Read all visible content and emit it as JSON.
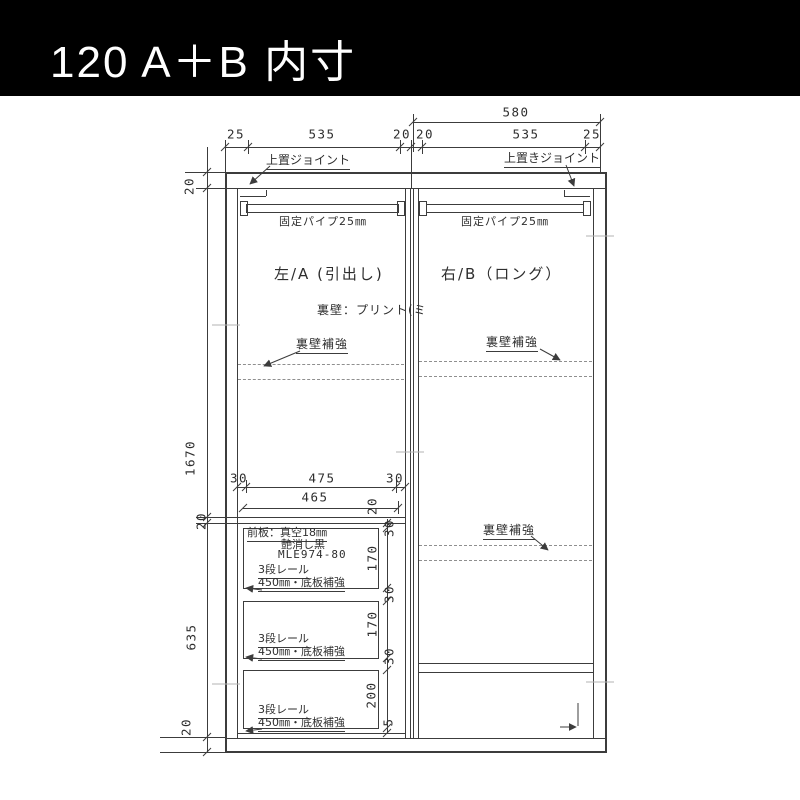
{
  "header": {
    "title": "120  A＋B  内寸"
  },
  "dimensions": {
    "overall_width_right": "580",
    "top_row": [
      "25",
      "535",
      "20",
      "20",
      "535",
      "25"
    ],
    "left_column": {
      "top_thickness": "20",
      "upper_height": "1670",
      "shelf_thickness": "20",
      "drawer_section_height": "635",
      "bottom_thickness": "20"
    },
    "inner_top": [
      "30",
      "475",
      "30"
    ],
    "inner_width": "465",
    "shelf_offset": "20",
    "drawer_column": [
      "30",
      "170",
      "30",
      "170",
      "30",
      "200",
      "5"
    ]
  },
  "labels": {
    "joint_left": "上置ジョイント",
    "joint_right": "上置きジョイント",
    "fixed_pipe": "固定パイプ25㎜",
    "section_left": "左/A (引出し)",
    "section_right": "右/B（ロング）",
    "back_wall": "裏壁：プリント(ミ",
    "back_wall_reinforce": "裏壁補強",
    "front_panel_line1": "前板：真空18㎜",
    "front_panel_line2": "艶消し黒",
    "front_panel_line3": "MLE974-80",
    "rail_line1": "3段レール",
    "rail_line2": "450㎜・底板補強"
  }
}
